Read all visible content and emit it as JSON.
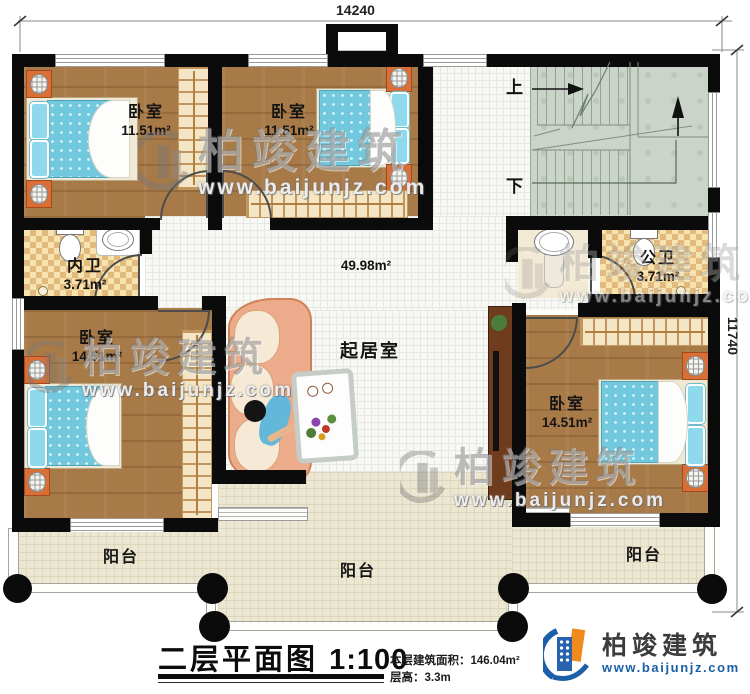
{
  "dimensions": {
    "width": "14240",
    "height": "11740"
  },
  "rooms": {
    "bedroom_tl": {
      "name": "卧室",
      "area": "11.51m²"
    },
    "bedroom_tm": {
      "name": "卧室",
      "area": "11.51m²"
    },
    "bedroom_bl": {
      "name": "卧室",
      "area": "14.51m²"
    },
    "bedroom_br": {
      "name": "卧室",
      "area": "14.51m²"
    },
    "bath_inner": {
      "name": "内卫",
      "area": "3.71m²"
    },
    "bath_public": {
      "name": "公卫",
      "area": "3.71m²"
    },
    "living": {
      "name": "起居室",
      "area": "49.98m²"
    },
    "balcony_left": {
      "name": "阳台"
    },
    "balcony_center": {
      "name": "阳台"
    },
    "balcony_right": {
      "name": "阳台"
    }
  },
  "stairs": {
    "up": "上",
    "down": "下"
  },
  "titleblock": {
    "title": "二层平面图",
    "scale": "1:100",
    "area_label": "本层建筑面积：",
    "area_value": "146.04m²",
    "height_label": "层高：",
    "height_value": "3.3m"
  },
  "brand": {
    "name": "柏竣建筑",
    "url": "www.baijunjz.com"
  },
  "watermark": {
    "name": "柏竣建筑",
    "url": "www.baijunjz.com"
  },
  "colors": {
    "wall": "#0b0b0b",
    "wood_floor": "#a87a48",
    "bath_tile": "#e3ba7d",
    "living_tile": "#f8f8f5",
    "balcony_floor": "#ebe7d2",
    "stair_floor": "#cbd4c9",
    "mattress": "#72c9de",
    "sofa": "#ecab8a",
    "brand_blue": "#1b5fa8",
    "brand_orange": "#f08a1d"
  }
}
